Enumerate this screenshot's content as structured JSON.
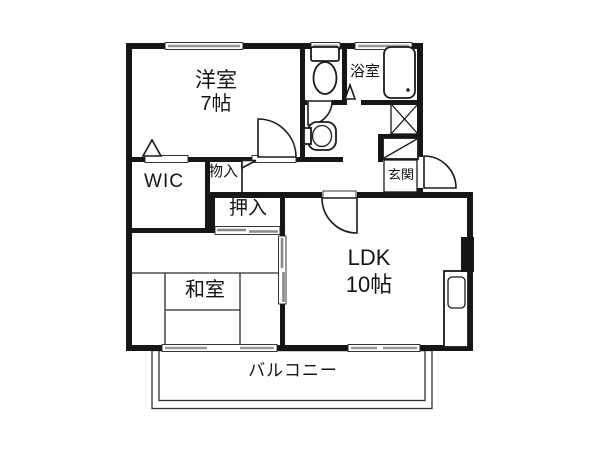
{
  "title": "2LDK apartment floor plan",
  "colors": {
    "background": "#ffffff",
    "wall": "#161616",
    "window_glass": "#9a9a9a",
    "line": "#222222"
  },
  "rooms": {
    "western": {
      "label": "洋室",
      "size": "7帖"
    },
    "bath": {
      "label": "浴室"
    },
    "wic": {
      "label": "WIC"
    },
    "storage": {
      "label": "物入"
    },
    "closet": {
      "label": "押入"
    },
    "entrance": {
      "label": "玄関"
    },
    "japanese": {
      "label": "和室"
    },
    "ldk": {
      "label": "LDK",
      "size": "10帖"
    },
    "balcony": {
      "label": "バルコニー"
    }
  },
  "fixtures": [
    "toilet-icon",
    "bathtub-icon",
    "washbasin-icon",
    "washing-machine-pan-icon",
    "shoe-cabinet-icon",
    "kitchen-sink-icon"
  ]
}
